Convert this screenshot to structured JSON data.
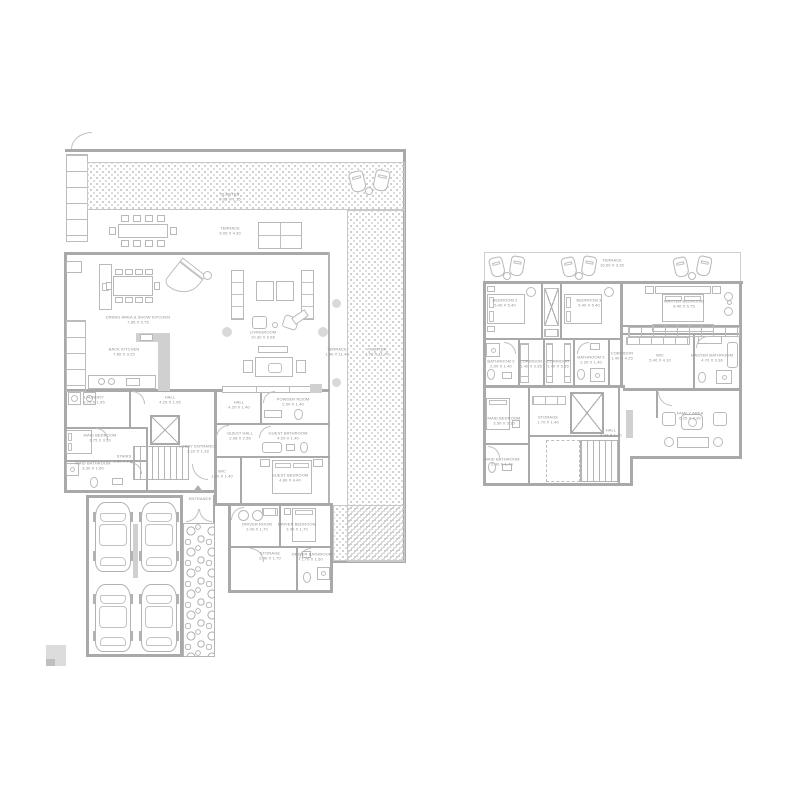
{
  "drawing_type": "residential floor plans, two levels side by side",
  "colors": {
    "wall": "#a9a9a9",
    "line": "#b9b9b9",
    "text": "#8f8f8f",
    "stipple": "#c9c9c9"
  },
  "floor1": {
    "labels": {
      "planter_top": {
        "name": "PLANTER",
        "dims": "9.05 X 1.15"
      },
      "terrace_top": {
        "name": "TERRACE",
        "dims": "9.05 X 4.30"
      },
      "terrace_right": {
        "name": "TERRACE",
        "dims": "1.40 X 11.40"
      },
      "planter_right": {
        "name": "PLANTER",
        "dims": "1.70 X 11.70"
      },
      "dining": {
        "name": "DINING AREA & SHOW KITCHEN",
        "dims": "7.85 X 5.75"
      },
      "livingroom": {
        "name": "LIVINGROOM",
        "dims": "10.30 X 9.65"
      },
      "back_kitchen": {
        "name": "BACK KITCHEN",
        "dims": "7.80 X 3.25"
      },
      "laundry": {
        "name": "LAUNDRY",
        "dims": "3.70 X 1.95"
      },
      "hall_a": {
        "name": "HALL",
        "dims": "4.25 X 1.95"
      },
      "maid_bedroom": {
        "name": "MAID BEDROOM",
        "dims": "3.75 X 3.50"
      },
      "maid_bathroom": {
        "name": "MAID BATHROOM",
        "dims": "3.30 X 1.60"
      },
      "stairs": {
        "name": "STAIRS",
        "dims": "1.30 X 2.60"
      },
      "lobby": {
        "name": "LOBBY ENTRANCE",
        "dims": "3.10 X 1.28"
      },
      "hall_b": {
        "name": "HALL",
        "dims": "4.20 X 1.40"
      },
      "powder": {
        "name": "POWDER ROOM",
        "dims": "2.00 X 1.40"
      },
      "guest_hall": {
        "name": "GUEST HALL",
        "dims": "2.08 X 2.56"
      },
      "guest_bath": {
        "name": "GUEST BATHROOM",
        "dims": "4.20 X 1.40"
      },
      "wic": {
        "name": "WIC",
        "dims": "1.60 X 1.40"
      },
      "guest_bedroom": {
        "name": "GUEST BEDROOM",
        "dims": "4.80 X 4.40"
      },
      "driver_room": {
        "name": "DRIVER ROOM",
        "dims": "2.40 X 1.70"
      },
      "driver_bedroom": {
        "name": "DRIVER BEDROOM",
        "dims": "2.40 X 1.70"
      },
      "storage": {
        "name": "STORAGE",
        "dims": "2.40 X 1.70"
      },
      "driver_bath": {
        "name": "DRIVER BATHROOM",
        "dims": "1.70 X 1.50"
      },
      "entrance": {
        "name": "ENTRANCE"
      }
    }
  },
  "floor2": {
    "labels": {
      "terrace": {
        "name": "TERRACE",
        "dims": "16.60 X 3.35"
      },
      "bedroom2": {
        "name": "BEDROOM 2",
        "dims": "5.40 X 5.40"
      },
      "bedroom3": {
        "name": "BEDROOM 3",
        "dims": "5.40 X 5.40"
      },
      "master": {
        "name": "MASTER BEDROOM",
        "dims": "6.40 X 5.75"
      },
      "bathroom2": {
        "name": "BATHROOM 2",
        "dims": "2.00 X 1.40"
      },
      "corridor_a": {
        "name": "CORRIDOR",
        "dims": "1.40 X 3.35"
      },
      "corridor_b": {
        "name": "CORRIDOR",
        "dims": "1.40 X 3.35"
      },
      "bathroom3": {
        "name": "BATHROOM 3",
        "dims": "2.20 X 1.40"
      },
      "corridor_c": {
        "name": "CORRIDOR",
        "dims": "1.40 X 4.25"
      },
      "wic": {
        "name": "WIC",
        "dims": "5.40 X 4.10"
      },
      "master_bath": {
        "name": "MASTER BATHROOM",
        "dims": "4.70 X 3.36"
      },
      "maid_bedroom": {
        "name": "MAID BEDROOM",
        "dims": "3.50 X 3.10"
      },
      "maid_bathroom": {
        "name": "MAID BATHROOM",
        "dims": "2.40 X 1.70"
      },
      "storage": {
        "name": "STORAGE",
        "dims": "1.70 X 1.40"
      },
      "hall": {
        "name": "HALL",
        "dims": "2.42 X 1.70"
      },
      "family": {
        "name": "FAMILY AREA",
        "dims": "6.25 X 4.30"
      }
    }
  }
}
